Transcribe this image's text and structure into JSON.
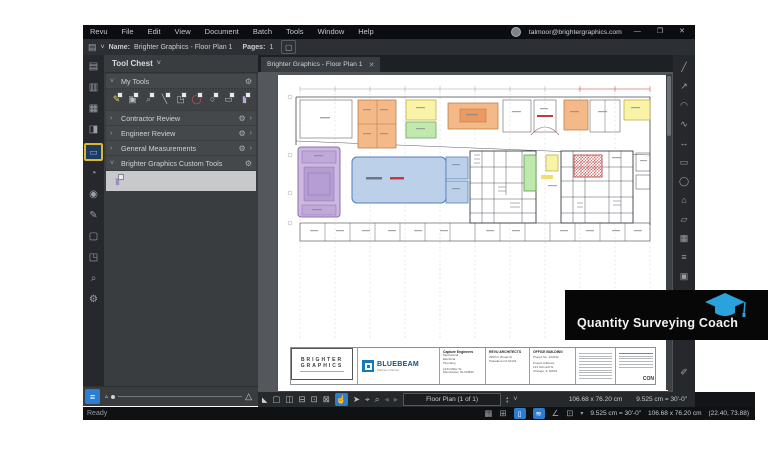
{
  "menu": [
    "Revu",
    "File",
    "Edit",
    "View",
    "Document",
    "Batch",
    "Tools",
    "Window",
    "Help"
  ],
  "titlebar": {
    "account": "talmoor@brightergraphics.com",
    "minimize": "—",
    "restore": "❐",
    "close": "✕"
  },
  "filebar": {
    "file_icon": "▤",
    "dropdown": "˅",
    "name_label": "Name:",
    "name_value": "Brighter Graphics - Floor Plan 1",
    "pages_label": "Pages:",
    "pages_value": "1",
    "page_button": "▢"
  },
  "tab": {
    "title": "Brighter Graphics - Floor Plan 1",
    "close": "✕"
  },
  "left_toolbar": [
    {
      "name": "file-access",
      "glyph": "▤"
    },
    {
      "name": "bookmarks",
      "glyph": "▥"
    },
    {
      "name": "thumbnails",
      "glyph": "▦"
    },
    {
      "name": "sets",
      "glyph": "◨"
    },
    {
      "name": "tool-chest",
      "glyph": "▭"
    },
    {
      "name": "layers",
      "glyph": "◔"
    },
    {
      "name": "stamps",
      "glyph": "◉"
    },
    {
      "name": "signatures",
      "glyph": "✎"
    },
    {
      "name": "shapes",
      "glyph": "▢"
    },
    {
      "name": "capture",
      "glyph": "◳"
    },
    {
      "name": "search",
      "glyph": "⌕"
    },
    {
      "name": "settings",
      "glyph": "⚙"
    }
  ],
  "tool_chest": {
    "title": "Tool Chest",
    "chevron": "˅",
    "gear": "⚙",
    "more": "›",
    "sections": [
      {
        "label": "My Tools",
        "chevron": "˅"
      },
      {
        "label": "Contractor Review",
        "chevron": "›"
      },
      {
        "label": "Engineer Review",
        "chevron": "›"
      },
      {
        "label": "General Measurements",
        "chevron": "›"
      },
      {
        "label": "Brighter Graphics Custom Tools",
        "chevron": "˅"
      }
    ],
    "my_tools": [
      {
        "name": "highlight-tool",
        "glyph": "✎"
      },
      {
        "name": "callout-tool",
        "glyph": "▣"
      },
      {
        "name": "zoom-region-tool",
        "glyph": "⌕"
      },
      {
        "name": "line-tool",
        "glyph": "╲"
      },
      {
        "name": "leader-tool",
        "glyph": "◳"
      },
      {
        "name": "ellipse-tool",
        "glyph": "◯"
      },
      {
        "name": "circle-tool",
        "glyph": "○"
      },
      {
        "name": "rectangle-tool",
        "glyph": "▭"
      },
      {
        "name": "box-tool",
        "glyph": "▮"
      }
    ],
    "custom_tools": [
      {
        "name": "custom-purple-tool",
        "glyph": "▮"
      }
    ]
  },
  "right_toolbar": [
    {
      "name": "length-measure",
      "glyph": "╱"
    },
    {
      "name": "polylength-measure",
      "glyph": "↗"
    },
    {
      "name": "arc-measure",
      "glyph": "◠"
    },
    {
      "name": "curve-measure",
      "glyph": "∿"
    },
    {
      "name": "diameter-measure",
      "glyph": "↔"
    },
    {
      "name": "area-measure",
      "glyph": "▭"
    },
    {
      "name": "ellipse-area-measure",
      "glyph": "◯"
    },
    {
      "name": "polygon-measure",
      "glyph": "⌂"
    },
    {
      "name": "cutout-measure",
      "glyph": "▱"
    },
    {
      "name": "grid-measure",
      "glyph": "▦"
    },
    {
      "name": "markup-list",
      "glyph": "≡"
    },
    {
      "name": "label-tool",
      "glyph": "▣"
    },
    {
      "name": "calibrate-tool",
      "glyph": "✎"
    },
    {
      "name": "fill-tool",
      "glyph": "✐"
    }
  ],
  "navbar": {
    "grip": "◣",
    "icons": [
      {
        "name": "single-page",
        "glyph": "▢"
      },
      {
        "name": "side-by-side",
        "glyph": "◫"
      },
      {
        "name": "split-view",
        "glyph": "⊟"
      },
      {
        "name": "fit-page",
        "glyph": "⊡"
      },
      {
        "name": "snapshot",
        "glyph": "⊠"
      },
      {
        "name": "pan",
        "glyph": "☝"
      },
      {
        "name": "select",
        "glyph": "➤"
      },
      {
        "name": "text-select",
        "glyph": "⌖"
      },
      {
        "name": "zoom",
        "glyph": "⌕"
      }
    ],
    "prev": "◂",
    "next": "▸",
    "page_display": "Floor Plan (1 of 1)",
    "spin_up": "▴",
    "spin_down": "▾",
    "dropdown": "˅",
    "size": "106.68 x 76.20 cm",
    "scale": "9.525 cm = 30'-0\""
  },
  "statusbar": {
    "ready": "Ready",
    "grid_icon": "▦",
    "snap_icon": "⊞",
    "blue_icons": [
      {
        "name": "markup-mode",
        "glyph": "▯"
      },
      {
        "name": "sync",
        "glyph": "≋"
      }
    ],
    "angle_icon": "∠",
    "units_icon": "⊡",
    "units_dropdown": "▾",
    "scale": "9.525 cm = 30'-0\"",
    "size": "106.68 x 76.20 cm",
    "coords": "(22.40, 73.88)"
  },
  "badge": {
    "label": "Quantity Surveying Coach"
  },
  "title_block": {
    "brand_top": "BRIGHTER",
    "brand_bottom": "GRAPHICS",
    "bluebeam": "BLUEBEAM",
    "bluebeam_sub": "Platinum Partner",
    "col1_title": "Capture Engineers",
    "col1_lines": [
      "Mechanical",
      "Electrical",
      "Plumbing",
      "1234 Miller St",
      "Manchester, NH 03830"
    ],
    "col2_title": "REVU ARCHITECTS",
    "col2_lines": [
      "2950 N. Broad St",
      "Pasadena CA 91101"
    ],
    "col3_title": "OFFICE BUILDING",
    "col3_lines": [
      "Project No. 323232",
      "Project Address:",
      "123 Schmidt St",
      "Chicago, IL 60601"
    ],
    "partial_right": "CON"
  }
}
